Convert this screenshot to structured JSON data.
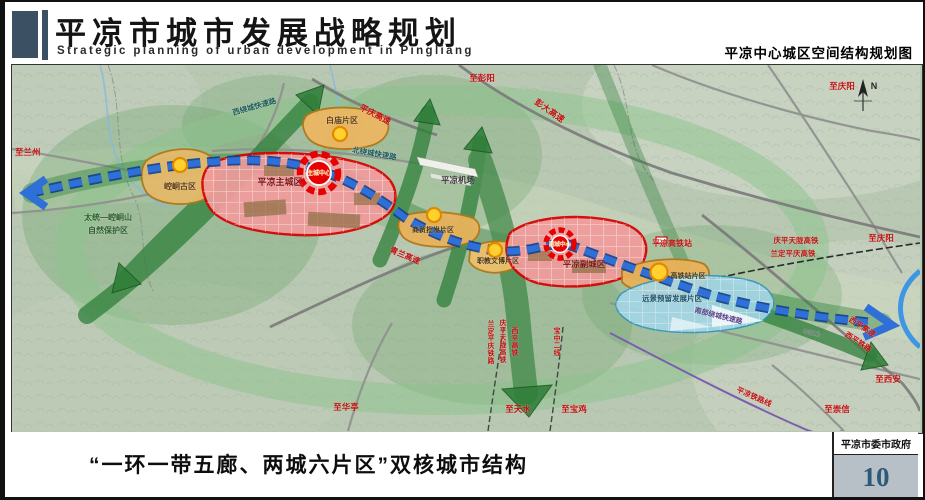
{
  "header": {
    "title_cn": "平凉市城市发展战略规划",
    "title_en": "Strategic planning of urban development in Pingliang",
    "map_name": "平凉中心城区空间结构规划图"
  },
  "footer": {
    "caption": "“一环一带五廊、两城六片区”双核城市结构",
    "agency": "平凉市委市政府",
    "page_number": "10"
  },
  "colors": {
    "accent_red": "#d60000",
    "axis_blue": "#2e6fd8",
    "corridor_green": "#2f7f3a",
    "zone_orange": "#e8b763",
    "zone_pink": "#f19b9b",
    "zone_blue": "#a5d8ea"
  },
  "map": {
    "compass": "N",
    "labels": [
      {
        "name": "to-lanzhou",
        "text": "至兰州",
        "x": 3,
        "y": 90,
        "color": "#c11111",
        "size": 8.5,
        "anchor": "start"
      },
      {
        "name": "to-pengyang",
        "text": "至彭阳",
        "x": 470,
        "y": 16,
        "color": "#c11111",
        "size": 8.5
      },
      {
        "name": "pengda-expressway",
        "text": "彭大高速",
        "x": 536,
        "y": 48,
        "rot": 35,
        "color": "#c11111",
        "size": 8.5
      },
      {
        "name": "pingqing-expressway",
        "text": "平庆高速",
        "x": 362,
        "y": 52,
        "rot": 27,
        "color": "#c11111",
        "size": 8.5
      },
      {
        "name": "west-ring-expressway",
        "text": "西绕城快速路",
        "x": 243,
        "y": 44,
        "rot": -16,
        "color": "#1e5a5a",
        "size": 7.5
      },
      {
        "name": "north-ring-expressway",
        "text": "北绕城快速路",
        "x": 362,
        "y": 91,
        "rot": 10,
        "color": "#1e5a5a",
        "size": 7.5
      },
      {
        "name": "baimiao-district",
        "text": "白庙片区",
        "x": 330,
        "y": 58,
        "color": "#5a3a10",
        "size": 8
      },
      {
        "name": "kongtong-ancient-district",
        "text": "崆峒古区",
        "x": 168,
        "y": 124,
        "color": "#5a3a10",
        "size": 8
      },
      {
        "name": "main-city",
        "text": "平凉主城区",
        "x": 268,
        "y": 120,
        "color": "#7a1515",
        "size": 9
      },
      {
        "name": "main-city-center",
        "text": "主城中心",
        "x": 307,
        "y": 110,
        "color": "#ffe9b0",
        "size": 6
      },
      {
        "name": "airport",
        "text": "平凉机场",
        "x": 446,
        "y": 118,
        "color": "#3a3a3a",
        "size": 8.5
      },
      {
        "name": "wholesale-district",
        "text": "商贸批发片区",
        "x": 421,
        "y": 167,
        "color": "#4a3510",
        "size": 7
      },
      {
        "name": "qinglan-expressway",
        "text": "青兰高速",
        "x": 392,
        "y": 193,
        "rot": 23,
        "color": "#c11111",
        "size": 8
      },
      {
        "name": "culture-district",
        "text": "职教文博片区",
        "x": 486,
        "y": 198,
        "color": "#4a3510",
        "size": 7
      },
      {
        "name": "sub-city",
        "text": "平凉副城区",
        "x": 572,
        "y": 202,
        "color": "#7a1515",
        "size": 8.5
      },
      {
        "name": "sub-city-center",
        "text": "副城中心",
        "x": 548,
        "y": 181,
        "color": "#ffe9b0",
        "size": 5.5
      },
      {
        "name": "hsr-station",
        "text": "平凉高铁站",
        "x": 660,
        "y": 181,
        "color": "#c11111",
        "size": 8
      },
      {
        "name": "hsr-district",
        "text": "高铁站片区",
        "x": 676,
        "y": 213,
        "color": "#4a3510",
        "size": 7
      },
      {
        "name": "reserve-district",
        "text": "远景预留发展片区",
        "x": 660,
        "y": 236,
        "color": "#1f4f63",
        "size": 7.5
      },
      {
        "name": "south-ring-expressway",
        "text": "南部绕城快速路",
        "x": 706,
        "y": 253,
        "rot": 14,
        "color": "#5a3f86",
        "size": 7
      },
      {
        "name": "qingping-tianlong-hsr",
        "text": "庆平天陇高铁",
        "x": 784,
        "y": 178,
        "color": "#c11111",
        "size": 7.5
      },
      {
        "name": "landing-pingqing-hsr",
        "text": "兰定平庆高铁",
        "x": 781,
        "y": 191,
        "color": "#c11111",
        "size": 7.5
      },
      {
        "name": "to-qingyang-east",
        "text": "至庆阳",
        "x": 869,
        "y": 176,
        "color": "#c11111",
        "size": 8.5
      },
      {
        "name": "to-qingyang-north",
        "text": "至庆阳",
        "x": 830,
        "y": 24,
        "color": "#c11111",
        "size": 8.5
      },
      {
        "name": "g312-road",
        "text": "G312",
        "x": 799,
        "y": 270,
        "rot": 12,
        "color": "#767676",
        "size": 7
      },
      {
        "name": "xiping-expressway",
        "text": "西平高速",
        "x": 849,
        "y": 264,
        "rot": 33,
        "color": "#c11111",
        "size": 7.5
      },
      {
        "name": "xiping-railway",
        "text": "西平铁路",
        "x": 845,
        "y": 279,
        "rot": 33,
        "color": "#c11111",
        "size": 7.5
      },
      {
        "name": "to-xian",
        "text": "至西安",
        "x": 876,
        "y": 317,
        "color": "#c11111",
        "size": 8.5
      },
      {
        "name": "to-chongxin",
        "text": "至崇信",
        "x": 825,
        "y": 347,
        "color": "#c11111",
        "size": 8.5
      },
      {
        "name": "pingliang-rail-line",
        "text": "平凉铁路线",
        "x": 741,
        "y": 334,
        "rot": 24,
        "color": "#c11111",
        "size": 7.5
      },
      {
        "name": "to-huating",
        "text": "至华亭",
        "x": 334,
        "y": 345,
        "color": "#c11111",
        "size": 8.5
      },
      {
        "name": "xiping-hsr-vertical",
        "text": "西平高铁",
        "x": 503,
        "y": 268,
        "vertical": true,
        "color": "#c11111",
        "size": 7
      },
      {
        "name": "qingping-tianlong-hsr-vertical",
        "text": "庆平天陇高铁",
        "x": 491,
        "y": 260,
        "vertical": true,
        "color": "#c11111",
        "size": 7
      },
      {
        "name": "landing-pingqing-railway-vertical",
        "text": "兰定平庆铁路",
        "x": 479,
        "y": 261,
        "vertical": true,
        "color": "#c11111",
        "size": 7
      },
      {
        "name": "baozhong-second-line-vertical",
        "text": "宝中二线",
        "x": 545,
        "y": 268,
        "vertical": true,
        "color": "#c11111",
        "size": 7
      },
      {
        "name": "to-tianshui",
        "text": "至天水",
        "x": 506,
        "y": 347,
        "color": "#c11111",
        "size": 8.5
      },
      {
        "name": "to-baoji",
        "text": "至宝鸡",
        "x": 562,
        "y": 347,
        "color": "#c11111",
        "size": 8.5
      },
      {
        "name": "nature-reserve-line1",
        "text": "太统—崆峒山",
        "x": 96,
        "y": 155,
        "color": "#2a5d2a",
        "size": 8
      },
      {
        "name": "nature-reserve-line2",
        "text": "自然保护区",
        "x": 96,
        "y": 168,
        "color": "#2a5d2a",
        "size": 8
      },
      {
        "name": "compass-n",
        "text": "N",
        "x": 862,
        "y": 24,
        "color": "#222222",
        "size": 9
      }
    ]
  }
}
